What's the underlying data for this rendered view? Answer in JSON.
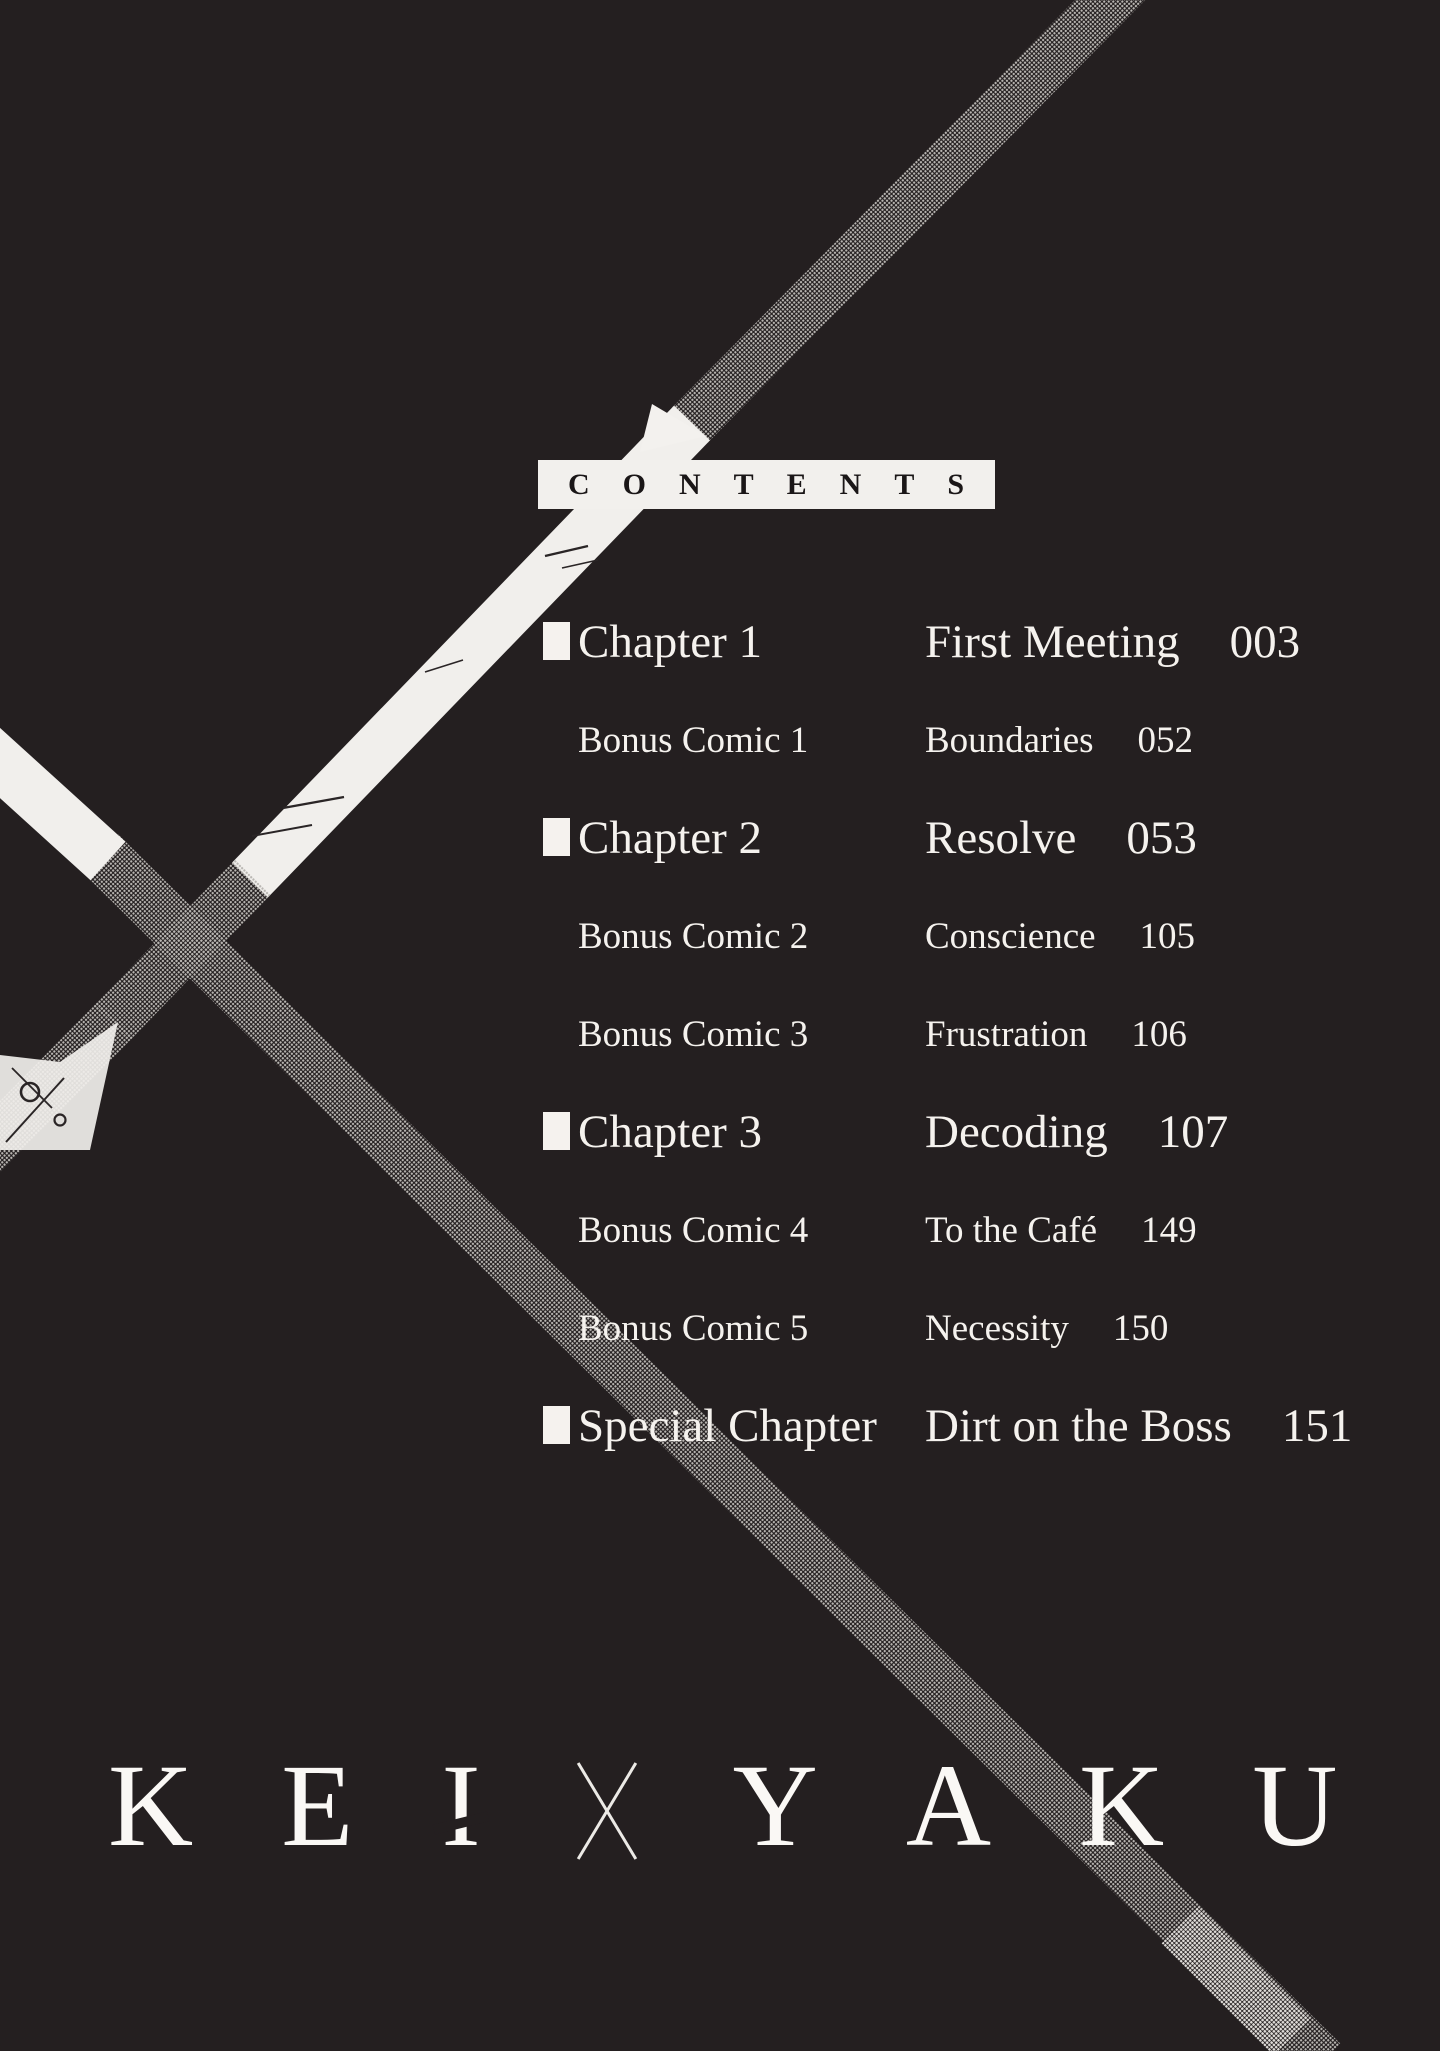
{
  "page": {
    "bg_color": "#241f20",
    "text_color": "#f5f2ee",
    "strip_gray": "#8a8784",
    "strip_white": "#f1efec"
  },
  "header": {
    "title": "CONTENTS"
  },
  "toc": {
    "rows": [
      {
        "type": "chapter",
        "label": "Chapter 1",
        "title": "First Meeting",
        "page": "003"
      },
      {
        "type": "bonus",
        "label": "Bonus Comic 1",
        "title": "Boundaries",
        "page": "052"
      },
      {
        "type": "chapter",
        "label": "Chapter 2",
        "title": "Resolve",
        "page": "053"
      },
      {
        "type": "bonus",
        "label": "Bonus Comic 2",
        "title": "Conscience",
        "page": "105"
      },
      {
        "type": "bonus",
        "label": "Bonus Comic 3",
        "title": "Frustration",
        "page": "106"
      },
      {
        "type": "chapter",
        "label": "Chapter 3",
        "title": "Decoding",
        "page": "107"
      },
      {
        "type": "bonus",
        "label": "Bonus Comic 4",
        "title": "To the Café",
        "page": "149"
      },
      {
        "type": "bonus",
        "label": "Bonus Comic 5",
        "title": "Necessity",
        "page": "150"
      },
      {
        "type": "chapter",
        "label": "Special Chapter",
        "title": "Dirt on the Boss",
        "page": "151"
      }
    ]
  },
  "logo": {
    "letters": [
      "K",
      "E",
      "I",
      "Y",
      "A",
      "K",
      "U"
    ],
    "separator": "×",
    "text": "KEI×YAKU"
  }
}
